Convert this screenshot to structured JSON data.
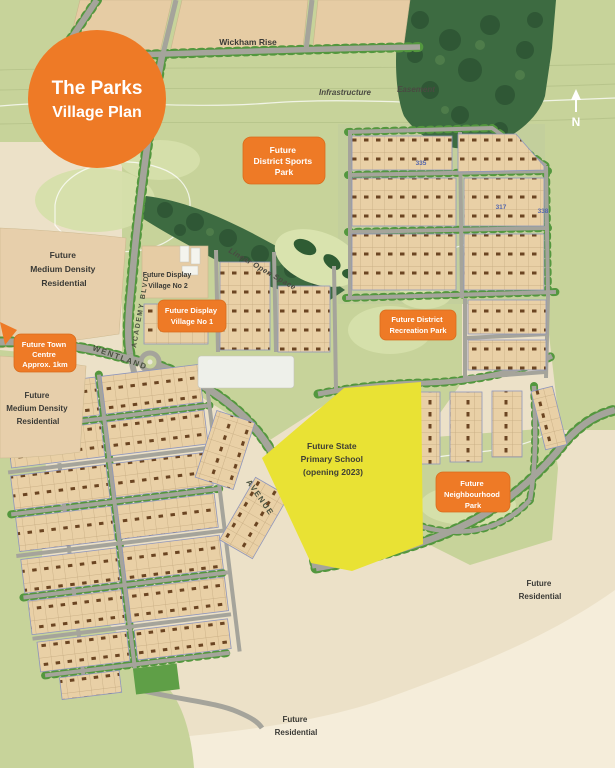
{
  "badge": {
    "title": "The Parks",
    "subtitle": "Village Plan"
  },
  "compass": {
    "label": "N"
  },
  "orange_labels": {
    "sports": [
      "Future",
      "District Sports",
      "Park"
    ],
    "town": [
      "Future Town",
      "Centre",
      "Approx. 1km"
    ],
    "dv1": [
      "Future Display",
      "Village No 1"
    ],
    "rec": [
      "Future District",
      "Recreation Park"
    ],
    "neigh": [
      "Future",
      "Neighbourhood",
      "Park"
    ]
  },
  "areas": {
    "wickham": "Wickham Rise",
    "infrastructure": "Infrastructure",
    "easement": "Easement",
    "md1": [
      "Future",
      "Medium Density",
      "Residential"
    ],
    "dv2": [
      "Future Display",
      "Village No 2"
    ],
    "linear": "Linear Open Space",
    "md2": [
      "Future",
      "Medium Density",
      "Residential"
    ],
    "school": [
      "Future State",
      "Primary School",
      "(opening 2023)"
    ],
    "fr_east": [
      "Future",
      "Residential"
    ],
    "fr_south": [
      "Future",
      "Residential"
    ]
  },
  "roads": {
    "academy": "ACADEMY BLVD",
    "wentland": "WENTLAND",
    "avenue": "AVENUE"
  },
  "stages": [
    "335",
    "317",
    "338"
  ],
  "colors": {
    "orange": "#ee7a26",
    "map_green": "#c7d39a",
    "forest_green": "#3d6b41",
    "lot_tan": "#e8cda3",
    "school_yellow": "#e9e234",
    "road_gray": "#a5a49b",
    "background_cream": "#ece1c8"
  }
}
